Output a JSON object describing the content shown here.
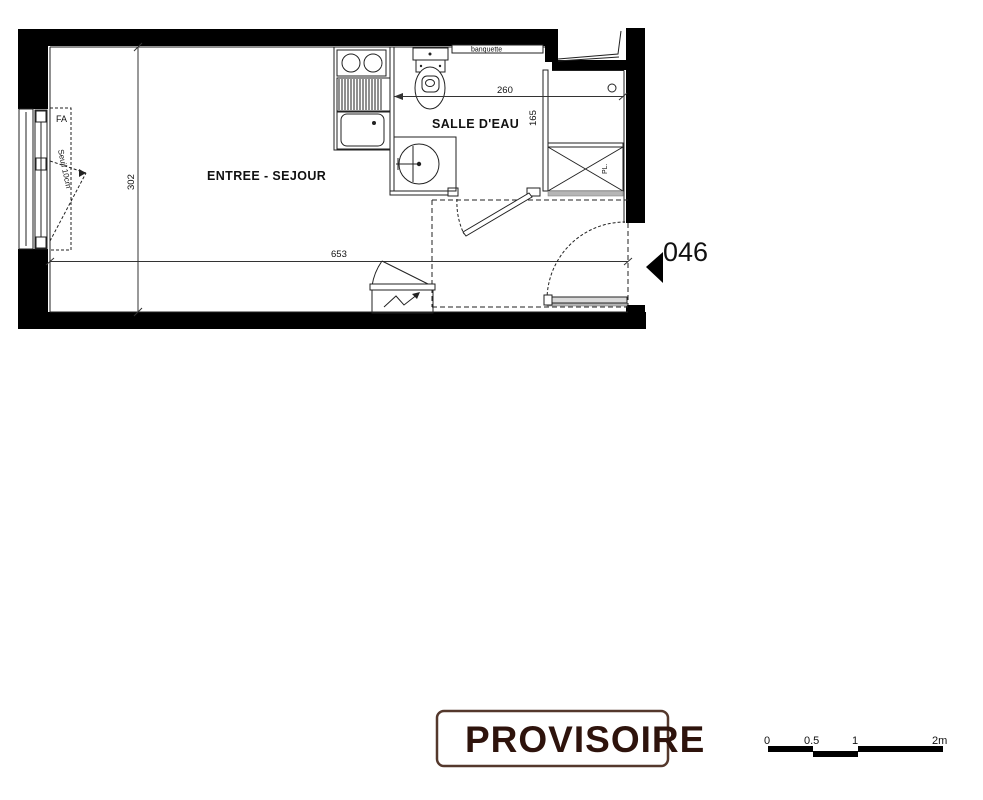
{
  "plan": {
    "unit_label": "046",
    "room_labels": {
      "main": "ENTREE - SEJOUR",
      "bathroom": "SALLE D'EAU"
    },
    "fixture_labels": {
      "bench": "banquette",
      "closet": "PL.",
      "window": "FA",
      "threshold": "Seuil 10cm"
    },
    "dimensions": {
      "main_width_cm": "653",
      "main_depth_cm": "302",
      "bathroom_width_cm": "260",
      "bathroom_depth_cm": "165"
    }
  },
  "stamp": {
    "text": "PROVISOIRE",
    "text_color": "#2e130c",
    "border_color": "#54382c"
  },
  "scale_bar": {
    "ticks": [
      "0",
      "0.5",
      "1",
      "2m"
    ],
    "bar_color": "#000000"
  },
  "colors": {
    "wall": "#000000",
    "line": "#222222",
    "background": "#ffffff"
  }
}
